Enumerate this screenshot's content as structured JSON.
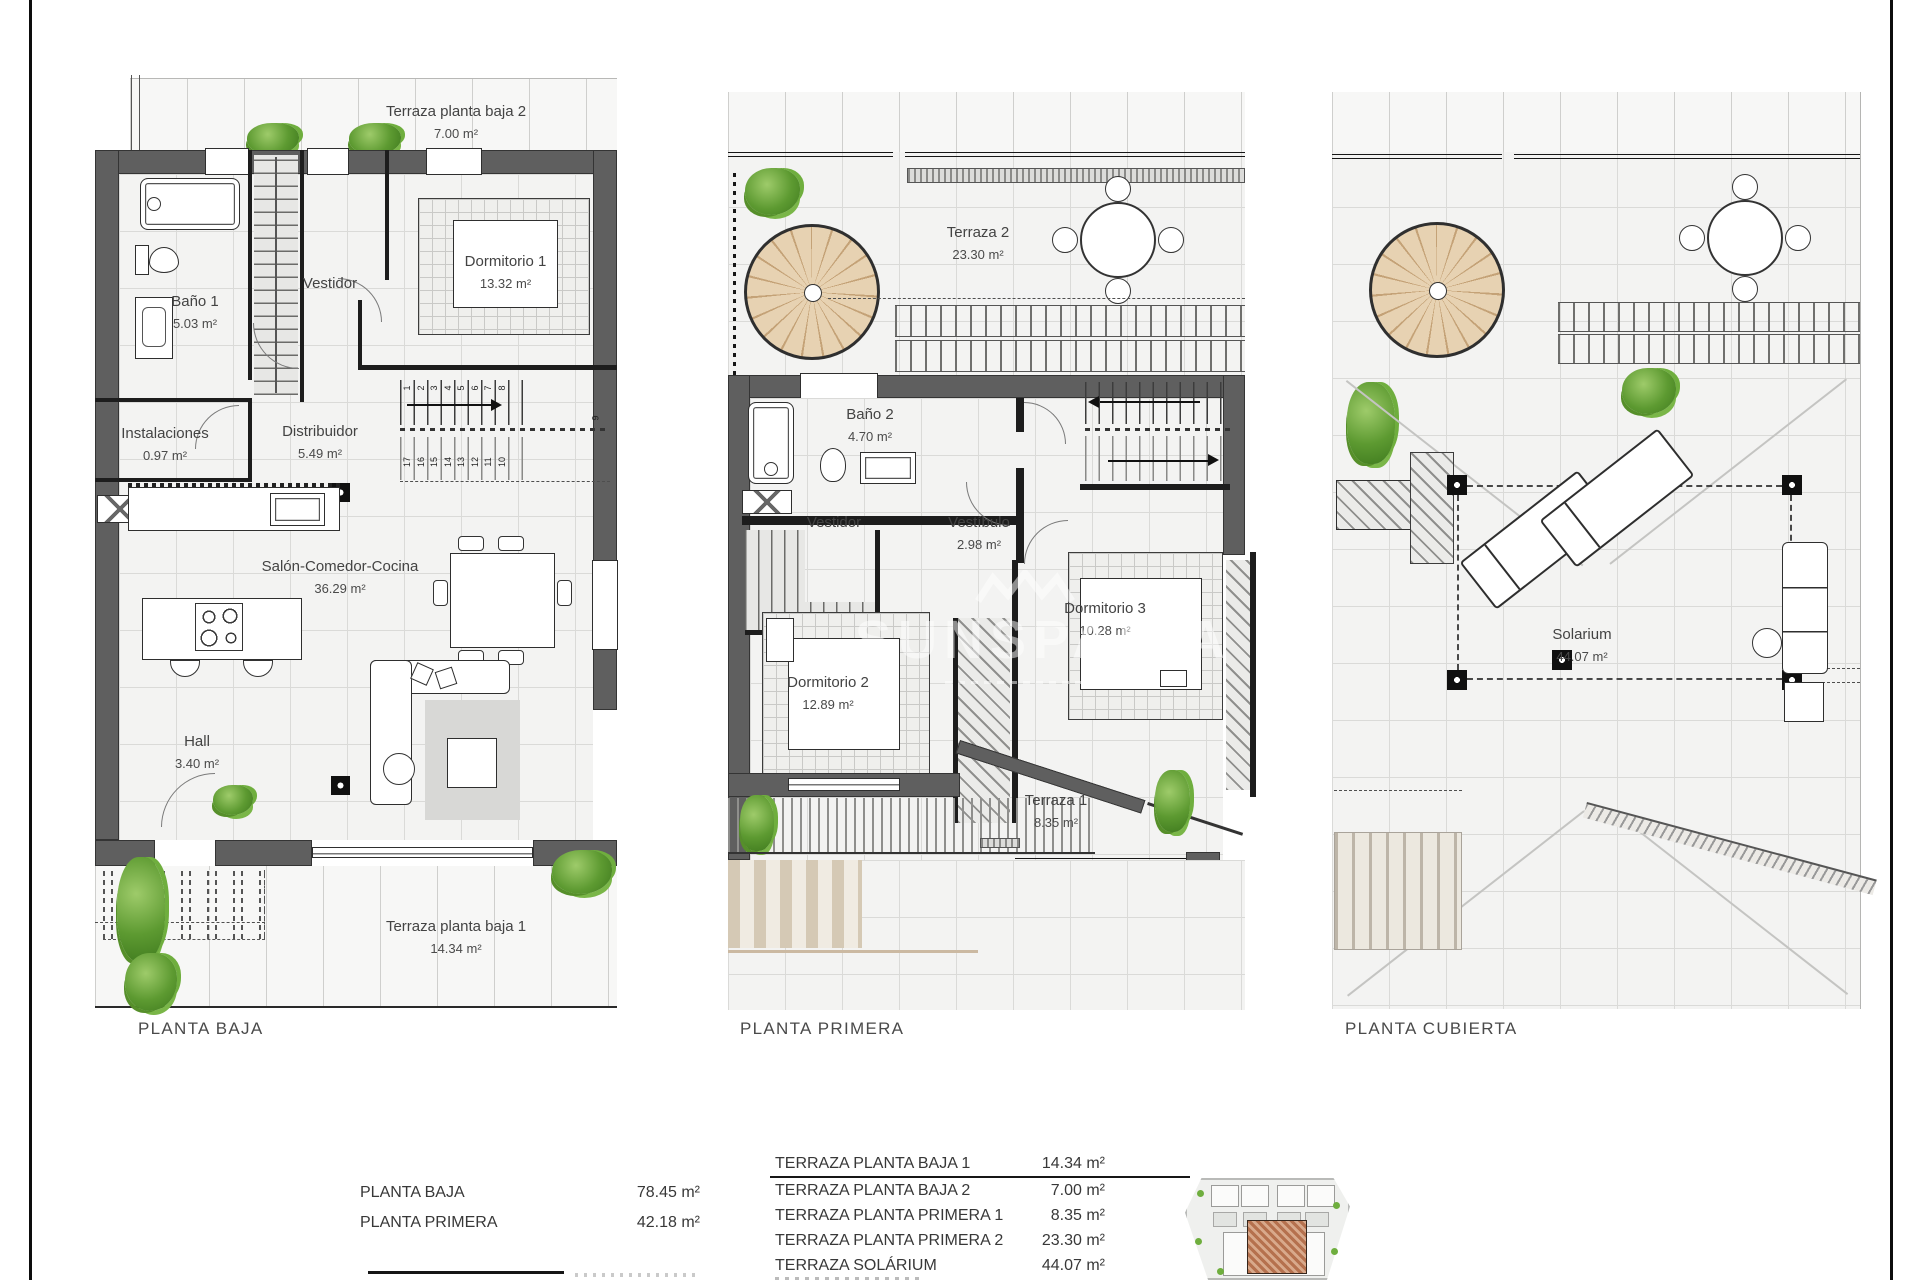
{
  "watermark": {
    "text": "SUNSPANIA"
  },
  "floors": {
    "baja": {
      "title": "PLANTA BAJA",
      "rooms": {
        "terraza_pb2": {
          "name": "Terraza planta baja 2",
          "area": "7.00 m²"
        },
        "bano1": {
          "name": "Baño 1",
          "area": "5.03 m²"
        },
        "vestidor": {
          "name": "Vestidor"
        },
        "dormitorio1": {
          "name": "Dormitorio 1",
          "area": "13.32 m²"
        },
        "instalaciones": {
          "name": "Instalaciones",
          "area": "0.97 m²"
        },
        "distribuidor": {
          "name": "Distribuidor",
          "area": "5.49 m²"
        },
        "salon": {
          "name": "Salón-Comedor-Cocina",
          "area": "36.29 m²"
        },
        "hall": {
          "name": "Hall",
          "area": "3.40 m²"
        },
        "terraza_pb1": {
          "name": "Terraza planta baja 1",
          "area": "14.34 m²"
        }
      },
      "stair_numbers_up": [
        "1",
        "2",
        "3",
        "4",
        "5",
        "6",
        "7",
        "8"
      ],
      "stair_number_mid": "9",
      "stair_numbers_down": [
        "17",
        "16",
        "15",
        "14",
        "13",
        "12",
        "11",
        "10"
      ]
    },
    "primera": {
      "title": "PLANTA PRIMERA",
      "rooms": {
        "terraza2": {
          "name": "Terraza 2",
          "area": "23.30 m²"
        },
        "bano2": {
          "name": "Baño 2",
          "area": "4.70 m²"
        },
        "vestidor": {
          "name": "Vestidor"
        },
        "vestibulo": {
          "name": "Vestíbulo",
          "area": "2.98 m²"
        },
        "dormitorio2": {
          "name": "Dormitorio 2",
          "area": "12.89 m²"
        },
        "dormitorio3": {
          "name": "Dormitorio 3",
          "area": "10.28 m²"
        },
        "terraza1": {
          "name": "Terraza 1",
          "area": "8.35 m²"
        }
      }
    },
    "cubierta": {
      "title": "PLANTA CUBIERTA",
      "rooms": {
        "solarium": {
          "name": "Solarium",
          "area": "44.07 m²"
        }
      }
    }
  },
  "summary": {
    "areas": [
      {
        "label": "PLANTA BAJA",
        "value": "78.45 m²"
      },
      {
        "label": "PLANTA PRIMERA",
        "value": "42.18 m²"
      }
    ],
    "terraces": [
      {
        "label": "TERRAZA PLANTA BAJA 1",
        "value": "14.34 m²"
      },
      {
        "label": "TERRAZA PLANTA BAJA 2",
        "value": "7.00 m²"
      },
      {
        "label": "TERRAZA PLANTA PRIMERA 1",
        "value": "8.35 m²"
      },
      {
        "label": "TERRAZA PLANTA PRIMERA 2",
        "value": "23.30 m²"
      },
      {
        "label": "TERRAZA SOLÁRIUM",
        "value": "44.07 m²"
      }
    ]
  },
  "colors": {
    "wall": "#5f5f5f",
    "line": "#1c1c1c",
    "wood": "#e7d2b2",
    "plant": "#5d9a31",
    "highlight": "#b5714e"
  }
}
